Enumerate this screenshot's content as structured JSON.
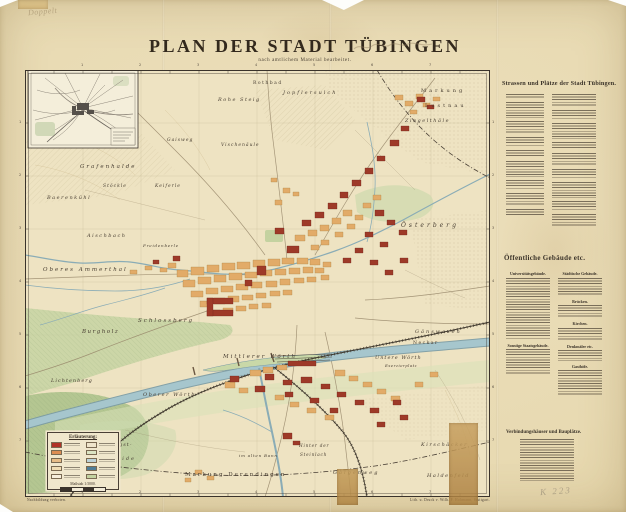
{
  "page": {
    "sheet_color": "#e9dcb8",
    "backing": "#fdfdfb"
  },
  "title": {
    "main": "PLAN DER STADT TÜBINGEN",
    "subtitle": "nach amtlichem Material bearbeitet."
  },
  "pencil": {
    "top_left": "Doppelt",
    "catalog": "K 223"
  },
  "imprint": {
    "left": "Nachbildung verboten.",
    "right": "Lith. u. Druck v. Wilh. F. Hohmann, Stuttgart."
  },
  "side_panel": {
    "streets_title": "Strassen und Plätze der Stadt Tübingen.",
    "streets_col1": [
      2,
      6,
      5,
      4,
      3,
      6,
      4,
      5,
      3
    ],
    "streets_col2": [
      5,
      4,
      6,
      3,
      5,
      4,
      6,
      4,
      5
    ],
    "buildings_title": "Öffentliche Gebäude etc.",
    "subhead_university": "Universitätsgebäude.",
    "uni_lines": [
      24
    ],
    "subhead_state": "Sonstige Staatsgebäude.",
    "state_lines": [
      10
    ],
    "subhead_city": "Städtische Gebäude.",
    "city_lines": [
      7
    ],
    "subhead_bridges": "Brücken.",
    "bridges_lines": [
      5
    ],
    "subhead_churches": "Kirchen.",
    "churches_lines": [
      5
    ],
    "subhead_monuments": "Denkmäler etc.",
    "monuments_lines": [
      4
    ],
    "subhead_inns": "Gasthöfe.",
    "inns_lines": [
      10
    ],
    "verb_title": "Verbindungshäuser und Bauplätze.",
    "verb_lines": [
      16
    ]
  },
  "legend_box": {
    "title": "Erläuterung:",
    "scale_label": "Maßstab 1:5000.",
    "swatches_left": [
      "#b03226",
      "#dd8d52",
      "#e7bc87",
      "#f0ddb4",
      "#f6efdc"
    ],
    "swatches_right": [
      "#efe5cb",
      "#dbe4c3",
      "#bcd2d8",
      "#4f7d96",
      "#c3d2a0"
    ]
  },
  "map": {
    "ticks": {
      "top": [
        "1",
        "2",
        "3",
        "4",
        "5",
        "6",
        "7"
      ],
      "bottom": [
        "1",
        "2",
        "3",
        "4",
        "5",
        "6",
        "7"
      ],
      "left": [
        "1",
        "2",
        "3",
        "4",
        "5",
        "6",
        "7"
      ],
      "right": [
        "1",
        "2",
        "3",
        "4",
        "5",
        "6",
        "7"
      ]
    },
    "labels": {
      "rothbad": "Rothbad",
      "jopflersulch": "Jopflersulch",
      "rohe_steig": "Rohe Steig",
      "markung_ne": "Markung",
      "lustnau": "Lustnau",
      "ziegelthaele": "Ziegelthäle",
      "gaisweg": "Gaisweg",
      "vischenaeule": "Vischenäule",
      "grafenhalde": "Grafenhalde",
      "stoeckle": "Stöckle",
      "keiferle": "Keiferle",
      "baerenkuehl": "Baerenkühl",
      "aischbach": "Aischbach",
      "freidenberle": "Freidenberle",
      "ammerthal": "Oberes Ammerthal",
      "schlossberg": "Schlossberg",
      "burgholz": "Burgholz",
      "lichtenberg": "Lichtenberg",
      "oesterberg": "Österberg",
      "gaenswasen": "Gänswasen",
      "neckar": "Neckar",
      "untere_woerth": "Untere Wörth",
      "exerzierplatz": "Exerzierplatz",
      "mittlerer_woerth": "Mittlerer Wörth",
      "oberer_woerth": "Oberer Wörth",
      "pfingst": "Pfingst-",
      "weide": "weide",
      "hinter_der": "Hinter der",
      "steinlach": "Steinlach",
      "im_alten_bann": "im alten Bann",
      "markung_derendingen": "Markung Derendingen",
      "galgenweg": "Galgenweg",
      "kirschaecker": "Kirschäcker",
      "haldenfeld": "Haldenfeld"
    }
  },
  "colors": {
    "river": "#a6c6cd",
    "river_edge": "#7899a4",
    "woods": "#c3d2a0",
    "forest": "#adc28c",
    "meadow": "#d8e1b8",
    "block_tan": "#e2ab68",
    "block_red": "#9e3a28",
    "railway": "#3f382e",
    "road": "#97876a",
    "ink": "#4a4036"
  }
}
